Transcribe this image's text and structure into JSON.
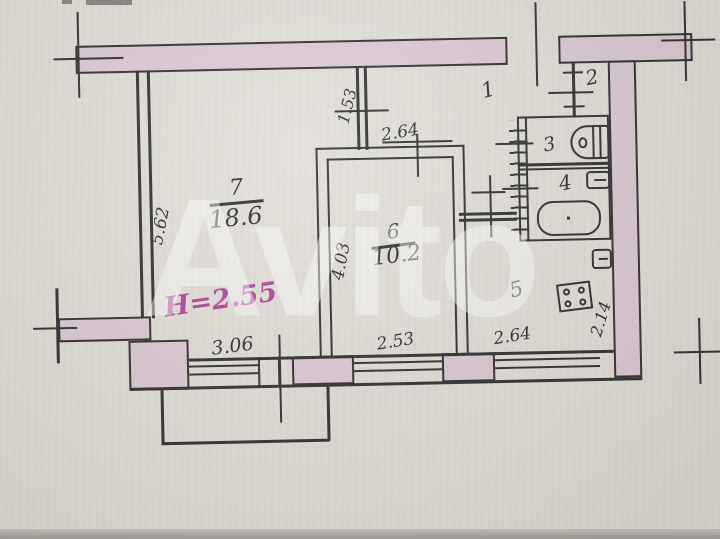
{
  "watermark": "Avito",
  "annotations": {
    "height_note": "H=2.55"
  },
  "rooms": {
    "r1": {
      "num": "1"
    },
    "r2": {
      "num": "2"
    },
    "r3": {
      "num": "3"
    },
    "r4": {
      "num": "4"
    },
    "r5": {
      "num": "5"
    },
    "r6": {
      "num": "6",
      "area": "10.2"
    },
    "r7": {
      "num": "7",
      "area": "18.6"
    }
  },
  "dimensions": {
    "room7_height": "5.62",
    "room6_height": "4.03",
    "entry_wall": "1.53",
    "room6_width": "2.64",
    "room7_width": "3.06",
    "room6_window": "2.53",
    "kitchen_window": "2.64",
    "kitchen_width": "2.14"
  },
  "colors": {
    "paper": "#dfdcd5",
    "wall": "#d8c6d2",
    "ink": "#242424",
    "magenta": "#a93a95",
    "watermark_c": "rgba(255,255,255,0.45)"
  }
}
